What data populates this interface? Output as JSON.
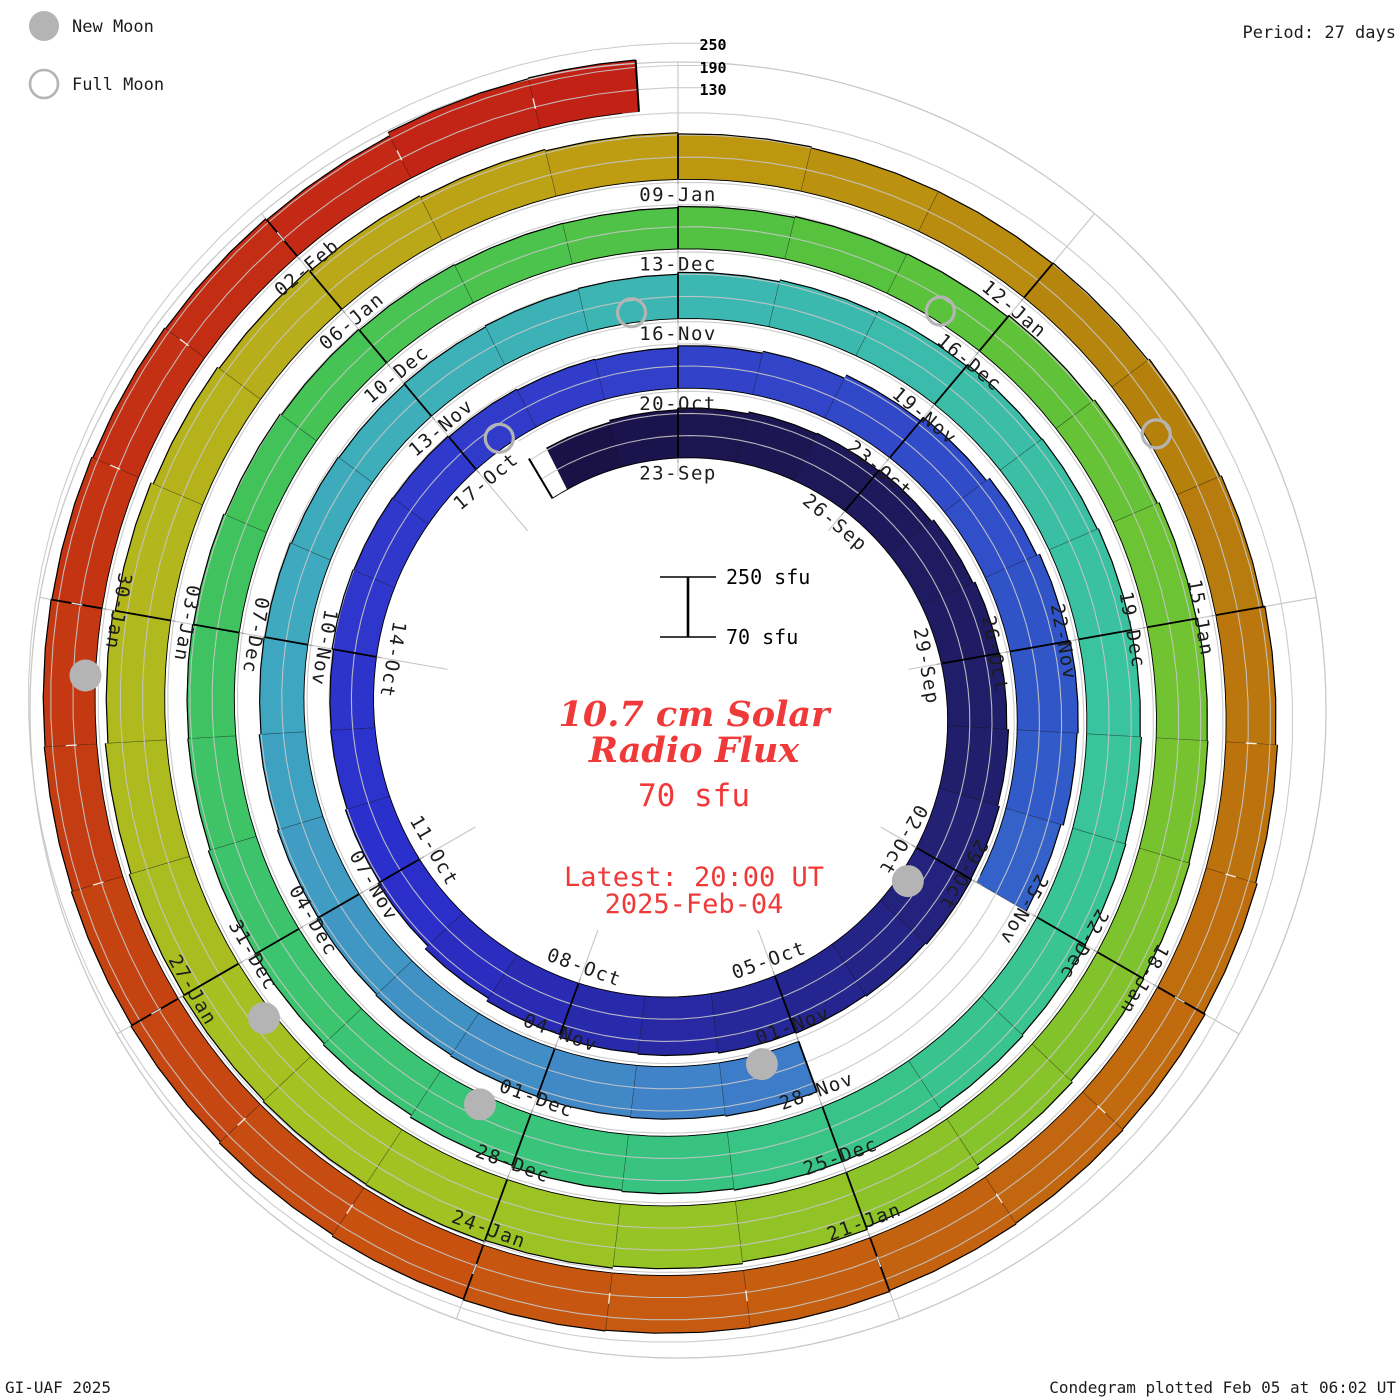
{
  "header": {
    "period_label": "Period: 27 days"
  },
  "legend": {
    "new_moon_label": "New Moon",
    "full_moon_label": "Full Moon",
    "moon_marker_color": "#b4b4b4"
  },
  "footer": {
    "left": "GI-UAF 2025",
    "right": "Condegram plotted Feb 05 at 06:02 UT"
  },
  "center_text": {
    "title_line1": "10.7 cm Solar",
    "title_line2": "Radio Flux",
    "current_value": "70 sfu",
    "latest_line1": "Latest: 20:00 UT",
    "latest_line2": "2025-Feb-04",
    "accent_color": "#f03a3a"
  },
  "scale_bar": {
    "top_label": "250 sfu",
    "bottom_label": "70 sfu"
  },
  "radial_scale_labels": [
    "250",
    "190",
    "130"
  ],
  "chart_data": {
    "type": "bar",
    "subtype": "polar-spiral-condegram",
    "title": "10.7 cm Solar Radio Flux",
    "period_days": 27,
    "rotation_start_date": "2024-09-23",
    "series_start_date": "2024-09-21",
    "series_end_date": "2025-02-04",
    "series_end_fraction_of_day": 0.72,
    "flux_baseline_sfu": 70,
    "flux_axis_max_sfu": 250,
    "flux_gridlines_sfu": [
      130,
      190,
      250
    ],
    "date_labels": [
      "23-Sep",
      "26-Sep",
      "29-Sep",
      "02-Oct",
      "05-Oct",
      "08-Oct",
      "11-Oct",
      "14-Oct",
      "17-Oct",
      "20-Oct",
      "23-Oct",
      "26-Oct",
      "29-Oct",
      "01-Nov",
      "04-Nov",
      "07-Nov",
      "10-Nov",
      "13-Nov",
      "16-Nov",
      "19-Nov",
      "22-Nov",
      "25-Nov",
      "28-Nov",
      "01-Dec",
      "04-Dec",
      "07-Dec",
      "10-Dec",
      "13-Dec",
      "16-Dec",
      "19-Dec",
      "22-Dec",
      "25-Dec",
      "28-Dec",
      "31-Dec",
      "03-Jan",
      "06-Jan",
      "09-Jan",
      "12-Jan",
      "15-Jan",
      "18-Jan",
      "21-Jan",
      "24-Jan",
      "27-Jan",
      "30-Jan",
      "02-Feb"
    ],
    "daily_flux_sfu": [
      195,
      200,
      205,
      210,
      212,
      215,
      222,
      228,
      230,
      235,
      240,
      242,
      238,
      235,
      232,
      228,
      225,
      218,
      210,
      200,
      195,
      190,
      188,
      192,
      190,
      188,
      185,
      182,
      180,
      185,
      190,
      200,
      212,
      222,
      230,
      235,
      232,
      225,
      null,
      null,
      null,
      215,
      212,
      210,
      208,
      205,
      202,
      198,
      195,
      190,
      188,
      185,
      183,
      185,
      188,
      190,
      195,
      200,
      205,
      210,
      212,
      215,
      215,
      218,
      220,
      222,
      225,
      228,
      228,
      225,
      222,
      218,
      212,
      208,
      205,
      200,
      198,
      196,
      192,
      188,
      185,
      183,
      182,
      185,
      188,
      190,
      195,
      200,
      205,
      208,
      210,
      212,
      215,
      220,
      228,
      235,
      240,
      245,
      248,
      247,
      244,
      240,
      235,
      228,
      222,
      215,
      210,
      205,
      200,
      196,
      193,
      190,
      190,
      192,
      196,
      200,
      205,
      210,
      214,
      218,
      220,
      222,
      225,
      226,
      228,
      226,
      222,
      218,
      215,
      212,
      210,
      208,
      205,
      202,
      198,
      208,
      210
    ],
    "missing_data_dates": [
      "2024-10-29",
      "2024-10-30",
      "2024-10-31"
    ],
    "new_moon_dates": [
      "2024-10-02",
      "2024-11-01",
      "2024-12-01",
      "2024-12-30",
      "2025-01-29"
    ],
    "full_moon_dates": [
      "2024-10-17",
      "2024-11-15",
      "2024-12-15",
      "2025-01-13"
    ],
    "color_stops": [
      [
        -2,
        "#1a1145"
      ],
      [
        8,
        "#21206e"
      ],
      [
        18,
        "#2b2fcd"
      ],
      [
        27,
        "#3240c9"
      ],
      [
        34,
        "#3058c8"
      ],
      [
        41,
        "#4186c8"
      ],
      [
        48,
        "#3fa8c0"
      ],
      [
        55,
        "#3cb8b0"
      ],
      [
        61,
        "#39c49c"
      ],
      [
        68,
        "#38c47e"
      ],
      [
        76,
        "#40c35c"
      ],
      [
        83,
        "#58c23c"
      ],
      [
        90,
        "#7fc32c"
      ],
      [
        97,
        "#a2c322"
      ],
      [
        103,
        "#b5b51d"
      ],
      [
        108,
        "#bf9a12"
      ],
      [
        112,
        "#b5820c"
      ],
      [
        117,
        "#c06c0e"
      ],
      [
        123,
        "#c85410"
      ],
      [
        128,
        "#c43a12"
      ],
      [
        135,
        "#c21f16"
      ]
    ],
    "gridline_color": "#c6c6c6",
    "label_color": "#1c1c1c",
    "legend_position": "top-left"
  }
}
